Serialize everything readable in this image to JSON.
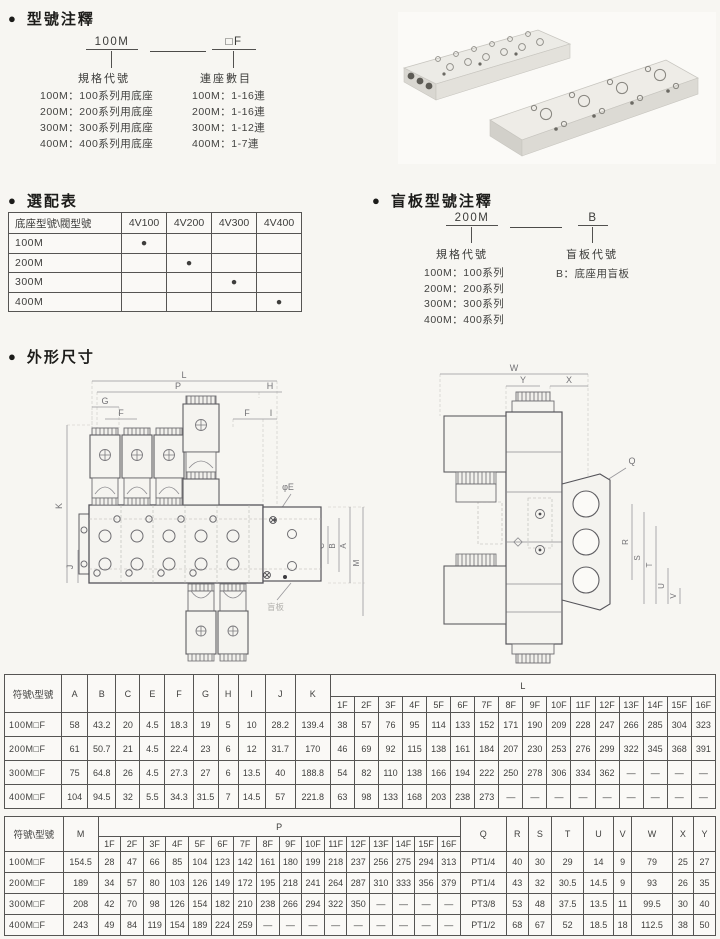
{
  "bullet": "●",
  "sec_model": {
    "title": "型號注釋",
    "left_code": "100M",
    "right_code": "□F",
    "left_label": "規格代號",
    "right_label": "連座數目",
    "left_items": [
      "100M：100系列用底座",
      "200M：200系列用底座",
      "300M：300系列用底座",
      "400M：400系列用底座"
    ],
    "right_items": [
      "100M：1-16連",
      "200M：1-16連",
      "300M：1-12連",
      "400M：1-7連"
    ]
  },
  "sec_select": {
    "title": "選配表",
    "table": {
      "corner": "底座型號\\閥型號",
      "cols": [
        "4V100",
        "4V200",
        "4V300",
        "4V400"
      ],
      "rows": [
        {
          "label": "100M",
          "cells": [
            "●",
            "",
            "",
            ""
          ]
        },
        {
          "label": "200M",
          "cells": [
            "",
            "●",
            "",
            ""
          ]
        },
        {
          "label": "300M",
          "cells": [
            "",
            "",
            "●",
            ""
          ]
        },
        {
          "label": "400M",
          "cells": [
            "",
            "",
            "",
            "●"
          ]
        }
      ]
    }
  },
  "sec_blind": {
    "title": "盲板型號注釋",
    "left_code": "200M",
    "right_code": "B",
    "left_label": "規格代號",
    "right_label": "盲板代號",
    "left_items": [
      "100M：100系列",
      "200M：200系列",
      "300M：300系列",
      "400M：400系列"
    ],
    "right_items": [
      "B：底座用盲板"
    ]
  },
  "sec_dims": {
    "title": "外形尺寸",
    "left_labels": [
      "L",
      "P",
      "H",
      "G",
      "F",
      "F",
      "I",
      "φE",
      "K",
      "J",
      "C",
      "B",
      "A",
      "M",
      "盲板"
    ],
    "right_labels": [
      "W",
      "Y",
      "X",
      "Q",
      "R",
      "S",
      "T",
      "U",
      "V"
    ]
  },
  "dim_table_1": {
    "corner": "符號\\型號",
    "fixed_cols": [
      "A",
      "B",
      "C",
      "E",
      "F",
      "G",
      "H",
      "I",
      "J",
      "K"
    ],
    "group_label": "L",
    "group_cols": [
      "1F",
      "2F",
      "3F",
      "4F",
      "5F",
      "6F",
      "7F",
      "8F",
      "9F",
      "10F",
      "11F",
      "12F",
      "13F",
      "14F",
      "15F",
      "16F"
    ],
    "rows": [
      {
        "label": "100M□F",
        "fixed": [
          "58",
          "43.2",
          "20",
          "4.5",
          "18.3",
          "19",
          "5",
          "10",
          "28.2",
          "139.4"
        ],
        "group": [
          "38",
          "57",
          "76",
          "95",
          "114",
          "133",
          "152",
          "171",
          "190",
          "209",
          "228",
          "247",
          "266",
          "285",
          "304",
          "323"
        ]
      },
      {
        "label": "200M□F",
        "fixed": [
          "61",
          "50.7",
          "21",
          "4.5",
          "22.4",
          "23",
          "6",
          "12",
          "31.7",
          "170"
        ],
        "group": [
          "46",
          "69",
          "92",
          "115",
          "138",
          "161",
          "184",
          "207",
          "230",
          "253",
          "276",
          "299",
          "322",
          "345",
          "368",
          "391"
        ]
      },
      {
        "label": "300M□F",
        "fixed": [
          "75",
          "64.8",
          "26",
          "4.5",
          "27.3",
          "27",
          "6",
          "13.5",
          "40",
          "188.8"
        ],
        "group": [
          "54",
          "82",
          "110",
          "138",
          "166",
          "194",
          "222",
          "250",
          "278",
          "306",
          "334",
          "362",
          "—",
          "—",
          "—",
          "—"
        ]
      },
      {
        "label": "400M□F",
        "fixed": [
          "104",
          "94.5",
          "32",
          "5.5",
          "34.3",
          "31.5",
          "7",
          "14.5",
          "57",
          "221.8"
        ],
        "group": [
          "63",
          "98",
          "133",
          "168",
          "203",
          "238",
          "273",
          "—",
          "—",
          "—",
          "—",
          "—",
          "—",
          "—",
          "—",
          "—"
        ]
      }
    ]
  },
  "dim_table_2": {
    "corner": "符號\\型號",
    "fixed_cols": [
      "M"
    ],
    "group_label": "P",
    "group_cols": [
      "1F",
      "2F",
      "3F",
      "4F",
      "5F",
      "6F",
      "7F",
      "8F",
      "9F",
      "10F",
      "11F",
      "12F",
      "13F",
      "14F",
      "15F",
      "16F"
    ],
    "tail_cols": [
      "Q",
      "R",
      "S",
      "T",
      "U",
      "V",
      "W",
      "X",
      "Y"
    ],
    "rows": [
      {
        "label": "100M□F",
        "fixed": [
          "154.5"
        ],
        "group": [
          "28",
          "47",
          "66",
          "85",
          "104",
          "123",
          "142",
          "161",
          "180",
          "199",
          "218",
          "237",
          "256",
          "275",
          "294",
          "313"
        ],
        "tail": [
          "PT1/4",
          "40",
          "30",
          "29",
          "14",
          "9",
          "79",
          "25",
          "27"
        ]
      },
      {
        "label": "200M□F",
        "fixed": [
          "189"
        ],
        "group": [
          "34",
          "57",
          "80",
          "103",
          "126",
          "149",
          "172",
          "195",
          "218",
          "241",
          "264",
          "287",
          "310",
          "333",
          "356",
          "379"
        ],
        "tail": [
          "PT1/4",
          "43",
          "32",
          "30.5",
          "14.5",
          "9",
          "93",
          "26",
          "35"
        ]
      },
      {
        "label": "300M□F",
        "fixed": [
          "208"
        ],
        "group": [
          "42",
          "70",
          "98",
          "126",
          "154",
          "182",
          "210",
          "238",
          "266",
          "294",
          "322",
          "350",
          "—",
          "—",
          "—",
          "—"
        ],
        "tail": [
          "PT3/8",
          "53",
          "48",
          "37.5",
          "13.5",
          "11",
          "99.5",
          "30",
          "40"
        ]
      },
      {
        "label": "400M□F",
        "fixed": [
          "243"
        ],
        "group": [
          "49",
          "84",
          "119",
          "154",
          "189",
          "224",
          "259",
          "—",
          "—",
          "—",
          "—",
          "—",
          "—",
          "—",
          "—",
          "—"
        ],
        "tail": [
          "PT1/2",
          "68",
          "67",
          "52",
          "18.5",
          "18",
          "112.5",
          "38",
          "50"
        ]
      }
    ]
  }
}
